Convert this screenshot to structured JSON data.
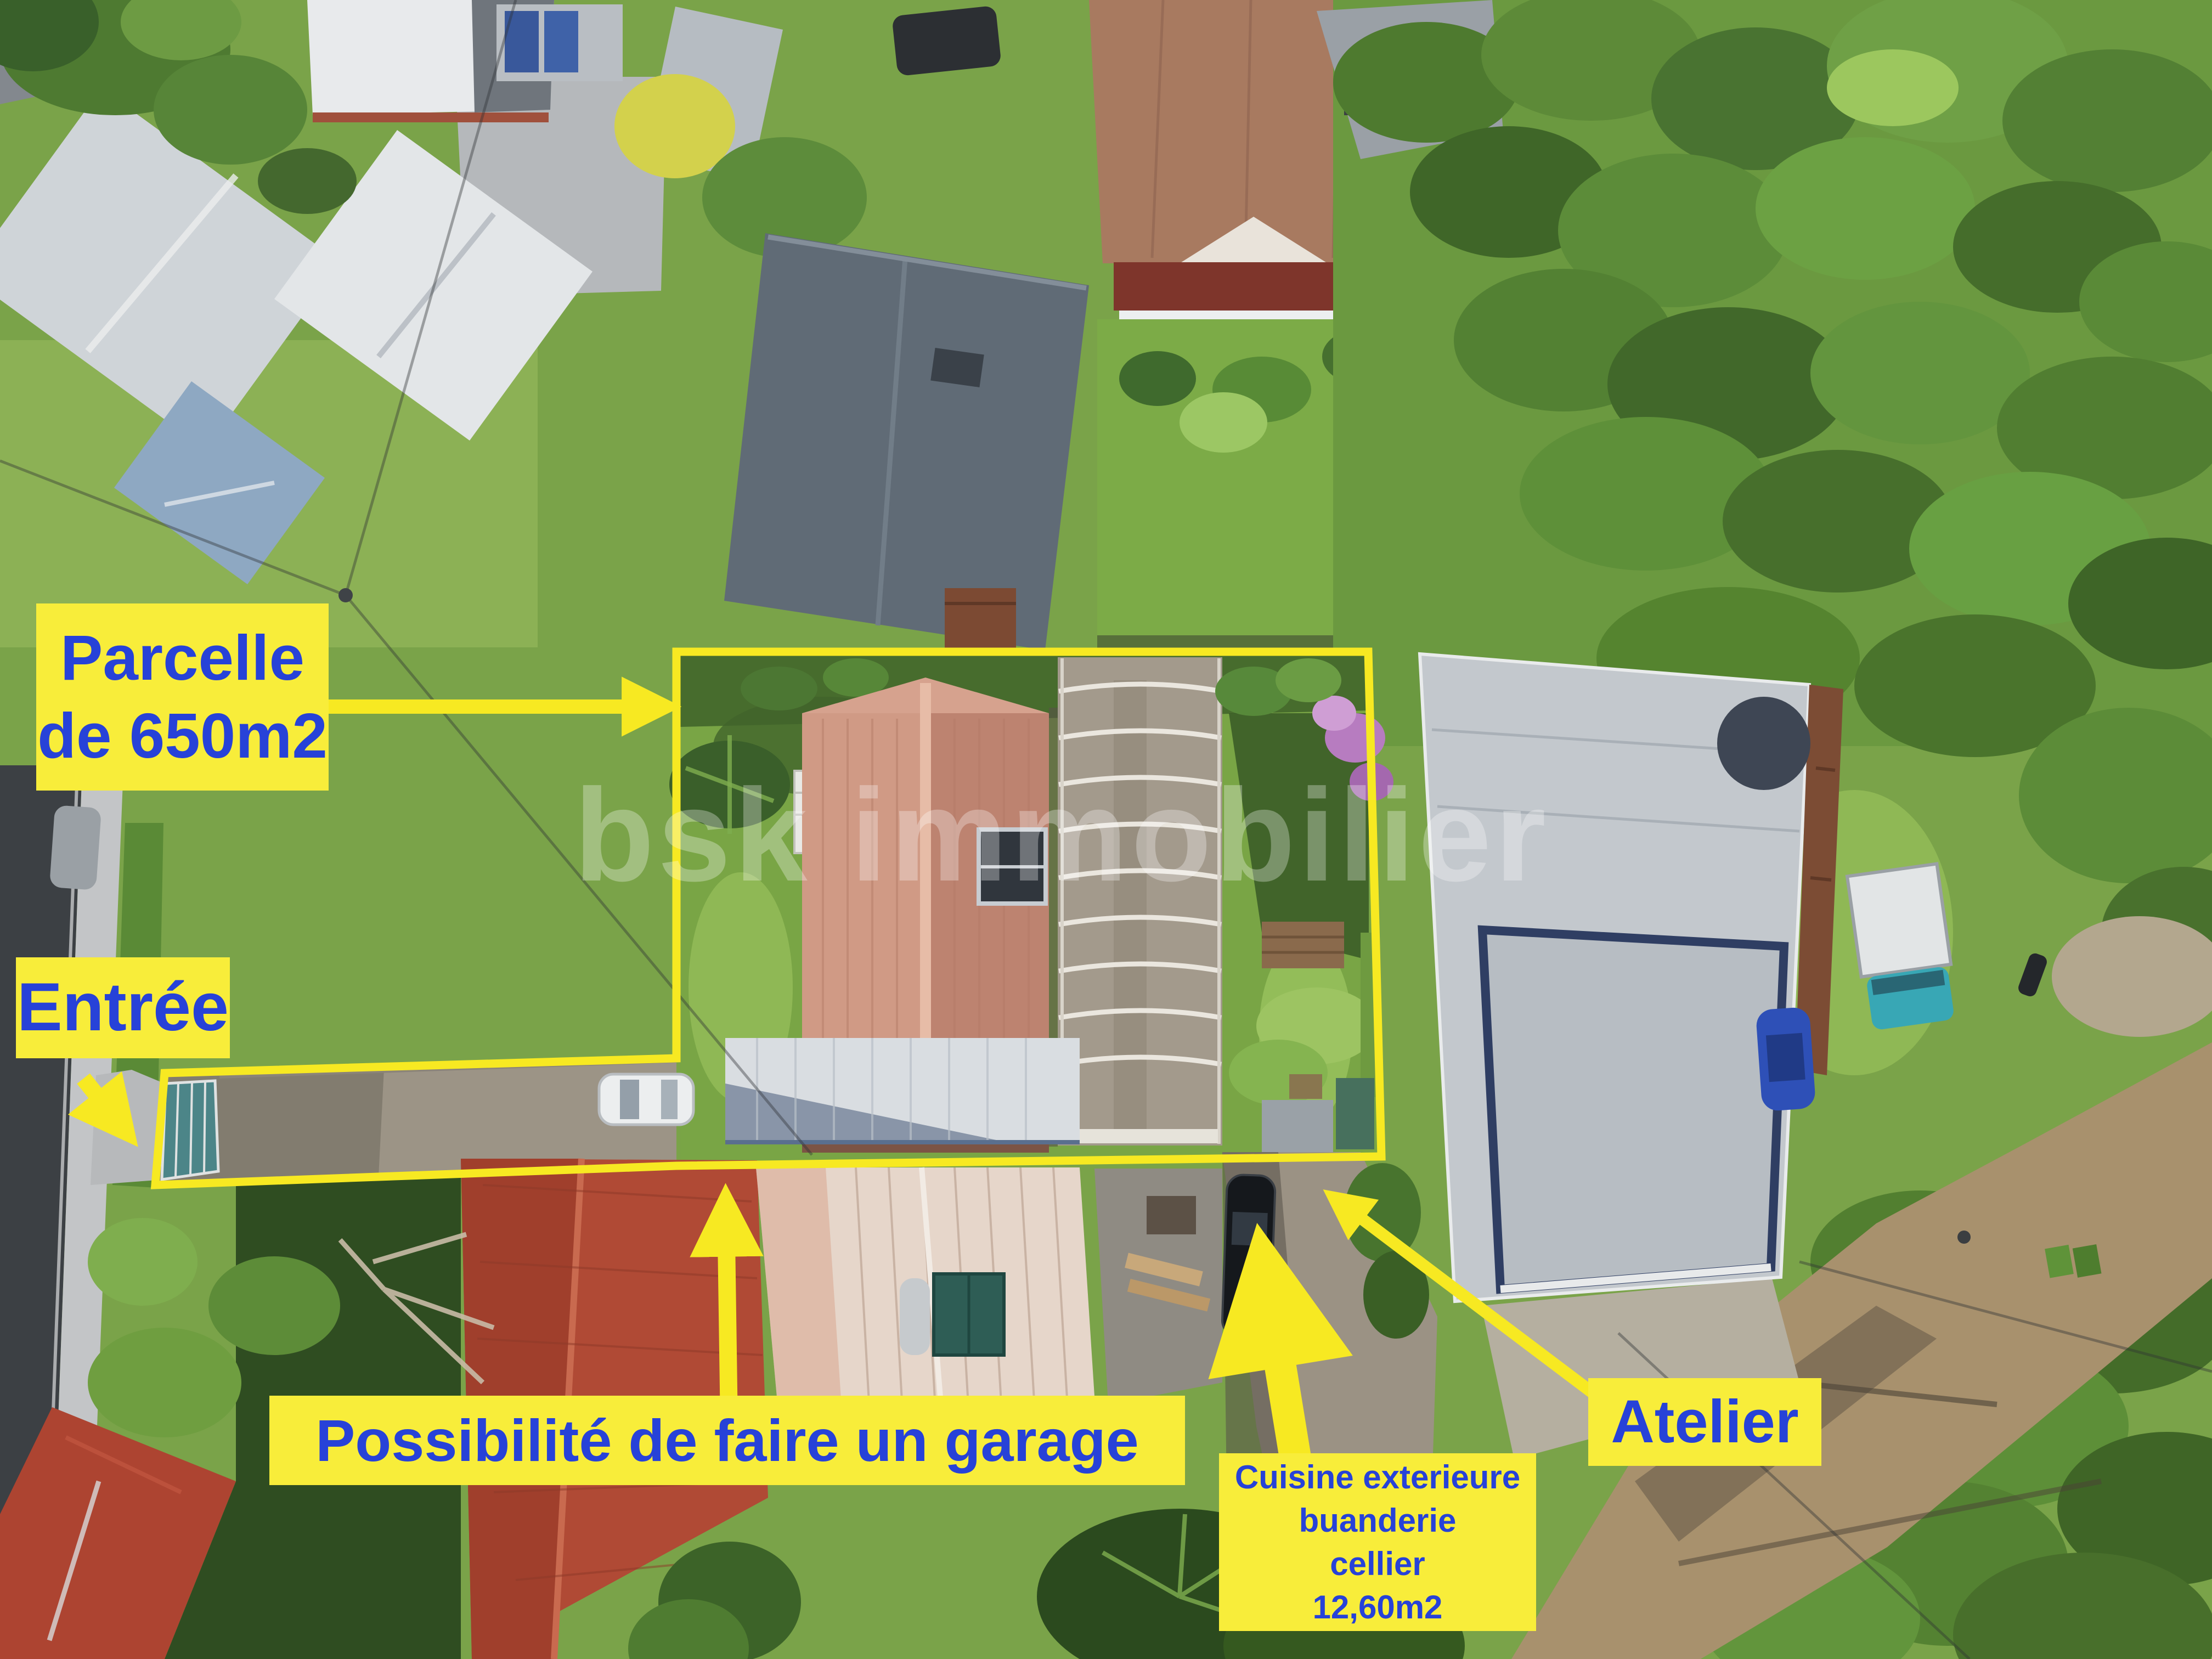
{
  "annotations": {
    "parcelle": {
      "line1": "Parcelle",
      "line2": "de 650m2"
    },
    "entree": {
      "label": "Entrée"
    },
    "garage": {
      "label": "Possibilité de faire un garage"
    },
    "cuisine": {
      "line1": "Cuisine exterieure",
      "line2": "buanderie",
      "line3": "cellier",
      "line4": "12,60m2"
    },
    "atelier": {
      "label": "Atelier"
    }
  },
  "watermark": {
    "text": "bsk immobilier"
  },
  "colors": {
    "annotation_background": "#f8ed3a",
    "annotation_text": "#2742d8",
    "annotation_yellow": "#f7e922",
    "watermark_white": "#ffffff"
  }
}
